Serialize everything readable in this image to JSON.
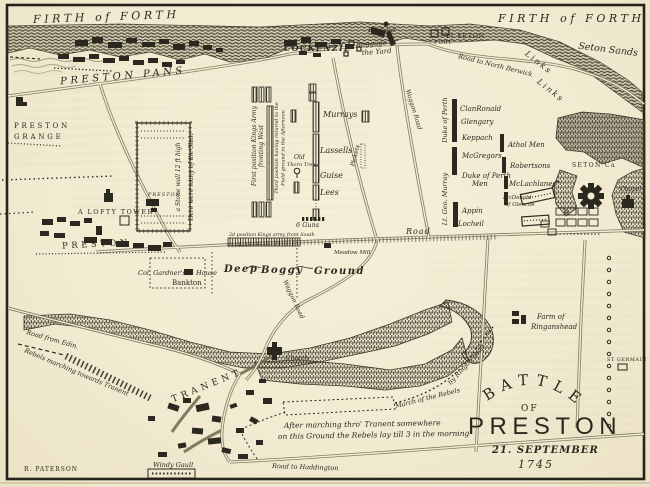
{
  "colors": {
    "paper": "#f3ecd3",
    "ink": "#2b281f",
    "road_line": "#6e684f",
    "woods": "#3c382a",
    "bleed_tint": "#7a8d56"
  },
  "coast": {
    "firth_of_forth": "FIRTH of FORTH",
    "seton_sands": "Seton Sands",
    "links": "Links",
    "harbour": "Harbour"
  },
  "towns": {
    "preston_pans": "PRESTON PANS",
    "cockenzie": "COCKENZIE",
    "port_seton": "Pt SETON",
    "fort": "FORT",
    "preston_grange_line1": "PRESTON",
    "preston_grange_line2": "GRANGE",
    "lofty_tower": "A LOFTY TOWER",
    "preston": "PRESTON",
    "park_preston": "PRESTON",
    "col_gardners": "Col. Gardner's",
    "house": "House",
    "bankton": "Bankton",
    "tranent": "TRANENT",
    "church": "Church",
    "seton_castle": "SETON Ca",
    "chapel": "Chapel",
    "st_germain": "ST GERMAIN",
    "farm_line1": "Farm of",
    "farm_line2": "Ringanshead",
    "meadow_mill": "Meadow Mill",
    "windy_gaull": "Windy Gaull"
  },
  "roads": {
    "to_north_berwick": "Road to North Berwick",
    "waggon": "Waggon Road",
    "road": "Road",
    "from_edinburgh": "Road from Edin.",
    "to_haddington": "Road to Haddington"
  },
  "royal_army": {
    "first_position_line1": "First position Kings Army",
    "first_position_line2": "fronting West",
    "third_position_line1": "Third position having returnd to the",
    "third_position_line2": "Field ground in the Afternoon",
    "second_position": "2d position Kings army front South",
    "murrays": "Murrays",
    "lassells": "Lassells",
    "guise": "Guise",
    "lees": "Lees",
    "pickets": "Pickets",
    "six_guns": "6 Guns",
    "baggage_line1": "Baggage in",
    "baggage_line2": "the Yard"
  },
  "highland_army": {
    "duke_of_perth_wing": "Duke of Perth",
    "lord_george_murray_wing": "Lt. Geo. Murray",
    "clanronald": "ClanRonald",
    "glengary": "Glengary",
    "keppach": "Keppach",
    "athol_men": "Athol Men",
    "mcgregors": "McGregors",
    "robertsons": "Robertsons",
    "duke_of_perth_men_line1": "Duke of Perth",
    "duke_of_perth_men_line2": "Men",
    "mclachlanes": "McLachlanes",
    "mcdonald_line1": "McDonald",
    "mcdonald_line2": "of Glencoe",
    "appin": "Appin",
    "locheil": "Locheil"
  },
  "annotations": {
    "stone_wall": "a Stone wall 12 ft high",
    "slain": "Here were many of the Slain",
    "old_thorn_line1": "Old",
    "old_thorn_line2": "Thorn Tree",
    "boggy_deep": "Deep",
    "boggy_boggy": "Boggy",
    "boggy_ground": "Ground",
    "rebels_marching": "Rebels marching towards Tranent",
    "night_line1": "After marching thro' Tranent somewhere",
    "night_line2": "on this Ground the Rebels lay till 3 in the morning",
    "march_line1": "March of the Rebels",
    "march_line2": "by Ringan head"
  },
  "title_block": {
    "battle": "BATTLE",
    "of": "OF",
    "name": "PRESTON",
    "date": "21. SEPTEMBER",
    "year": "1745"
  },
  "signature": "R. PATERSON"
}
